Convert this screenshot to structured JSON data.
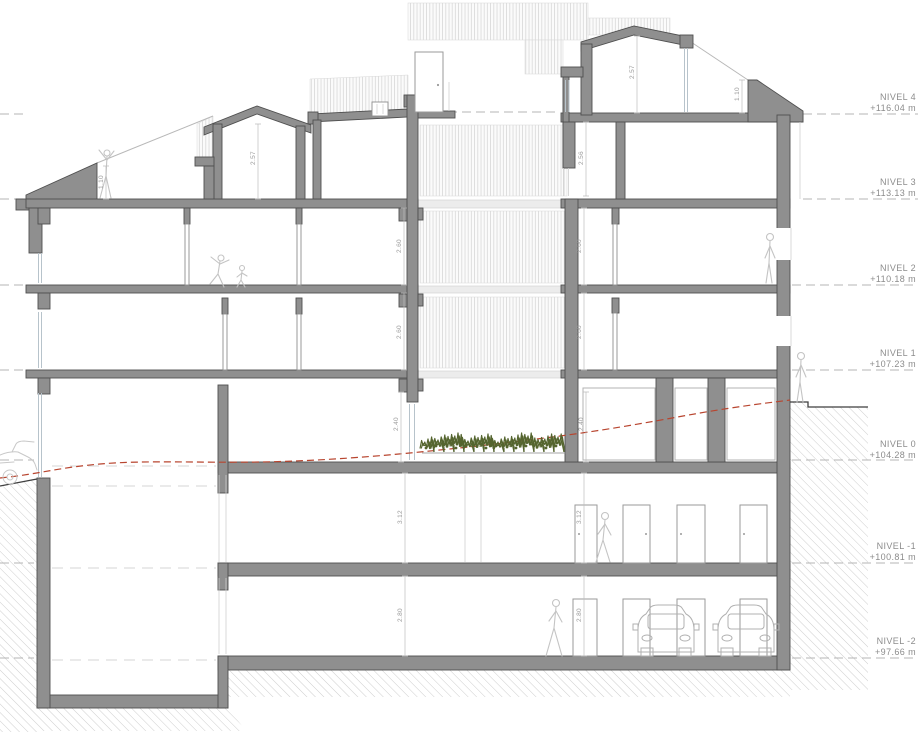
{
  "drawing": {
    "type": "architectural-building-section",
    "levels": [
      {
        "name": "NIVEL 4",
        "elev": "+116.04 m"
      },
      {
        "name": "NIVEL 3",
        "elev": "+113.13 m"
      },
      {
        "name": "NIVEL 2",
        "elev": "+110.18 m"
      },
      {
        "name": "NIVEL 1",
        "elev": "+107.23 m"
      },
      {
        "name": "NIVEL 0",
        "elev": "+104.28 m"
      },
      {
        "name": "NIVEL -1",
        "elev": "+100.81 m"
      },
      {
        "name": "NIVEL -2",
        "elev": "+97.66 m"
      }
    ],
    "dims": [
      {
        "id": "left-roof-parapet",
        "value": "1.10"
      },
      {
        "id": "left-attic-room",
        "value": "2.57"
      },
      {
        "id": "right-attic-room",
        "value": "2.57"
      },
      {
        "id": "right-roof-parapet",
        "value": "1.10"
      },
      {
        "id": "right-level3-room",
        "value": "2.56"
      },
      {
        "id": "left-level2-room",
        "value": "2.60"
      },
      {
        "id": "right-level2-room",
        "value": "2.60"
      },
      {
        "id": "left-level1-room",
        "value": "2.60"
      },
      {
        "id": "right-level1-room",
        "value": "2.60"
      },
      {
        "id": "left-level0-room",
        "value": "2.40"
      },
      {
        "id": "right-level0-room",
        "value": "2.40"
      },
      {
        "id": "left-basement1-room",
        "value": "3.12"
      },
      {
        "id": "right-basement1-room",
        "value": "3.12"
      },
      {
        "id": "left-basement2-room",
        "value": "2.80"
      },
      {
        "id": "right-basement2-room",
        "value": "2.80"
      }
    ],
    "colors": {
      "wall": "#8f8f8f",
      "outline": "#4f4f4f",
      "terrain_line": "#b8452f",
      "hedge": "#55652f",
      "level_text": "#8c8c8c",
      "dim_text": "#9a9a9a"
    }
  }
}
